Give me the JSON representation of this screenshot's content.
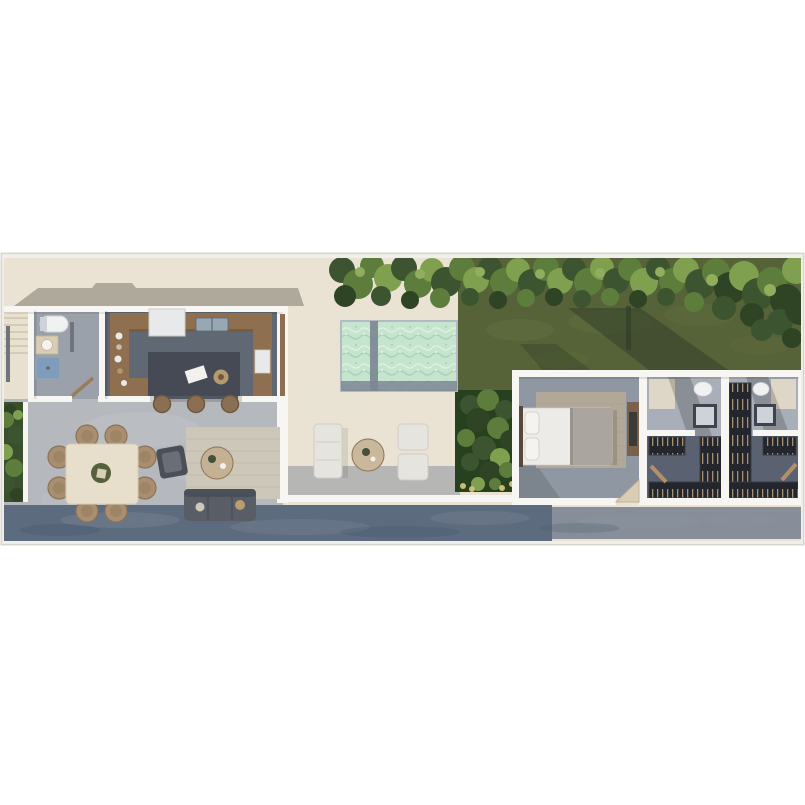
{
  "meta": {
    "kind": "aerial-3d-floor-plan-render",
    "canvas": {
      "width": 805,
      "height": 805
    },
    "plan_strip": {
      "top": 252,
      "height": 294
    }
  },
  "scene": {
    "description": "Top-down 3D rendering of a narrow-lot single-story home",
    "zones_left_to_right": [
      "staircase",
      "bathroom",
      "kitchen",
      "open living-dining",
      "pool terrace",
      "lawn with hedge",
      "garden bed",
      "bedroom",
      "closet-bath suite 1",
      "closet-bath suite 2",
      "street walkway"
    ],
    "furniture_counts": {
      "dining_chairs": 8,
      "bar_stools": 3,
      "outdoor_armchairs": 2,
      "outdoor_sofas": 1,
      "indoor_sofas": 1,
      "beds": 1
    },
    "pool_sections": 2
  },
  "palette": {
    "frame": "#f1efec",
    "frameEdge": "#d8d5cf",
    "cream": "#eae2d2",
    "roofShadow": "#a9a396",
    "wall": "#f8f6f2",
    "stairs": "#e9e1d0",
    "stairLine": "#cfc5ae",
    "rail": "#70747c",
    "floorLiving": "#b5b8bc",
    "floorPatch": "#c4c7ca",
    "floorKitchen": "#606874",
    "floorBath": "#9aa1ab",
    "wood": "#8e6f4f",
    "woodDark": "#6d5238",
    "appliance": "#e8e9ea",
    "sinkBlue": "#97a7b4",
    "showerBlue": "#7f9cba",
    "island": "#454a54",
    "paper": "#f2f1ee",
    "bowlTan": "#b5996f",
    "stool": "#8a6f52",
    "stoolEdge": "#6f583f",
    "tableCream": "#e7dfcb",
    "tableEdge": "#d6cbb2",
    "chairTan": "#a98f6f",
    "chairEdge": "#8a7357",
    "centerDark": "#55603d",
    "centerBeige": "#d9cfb8",
    "rugLiving": "#cdc7ba",
    "rugLine": "#b9b2a2",
    "armchair": "#4b5058",
    "armchairSeat": "#6a6f77",
    "coffeeTable": "#c4b193",
    "sofa": "#585d66",
    "sofaBack": "#4a4f58",
    "throwTan": "#b99e72",
    "throwLight": "#cfc9bb",
    "planterBase": "#3a4f2c",
    "gardenBase": "#27401f",
    "g1": "#3c5530",
    "g2": "#5d7d3c",
    "g3": "#7fa04e",
    "g4": "#2e4424",
    "g5": "#93ad5e",
    "flower": "#c9bd72",
    "grass": "#566238",
    "grassLight": "#61703f",
    "treeShadow": "#2f3b28",
    "deckShadow": "#8b929c",
    "poolWater": "#c6e5cf",
    "poolLight": "#def0e2",
    "poolDeep": "#a9d2b8",
    "poolEdgeDark": "#7b8694",
    "poolStroke": "#b3bac2",
    "outdoorWhite": "#e6e4de",
    "outdoorEdge": "#cfccc4",
    "outdoorTable": "#c9b89b",
    "outdoorDeco": "#44503a",
    "streetDark": "#5c6b7e",
    "streetLight": "#878e99",
    "streetPatchLight": "#8b97a6",
    "streetPatchDark": "#46566b",
    "floorBedroom": "#8e97a2",
    "rugBedroom": "#b2a898",
    "rugBedLine": "#a69c8c",
    "bedWhite": "#ecebe7",
    "bedGray": "#aaa69f",
    "bedFold": "#98948d",
    "pillow": "#f4f3f0",
    "headboard": "#54493c",
    "dresser": "#7b614a",
    "dresserDark": "#3c3a36",
    "doorWood": "#9a7b5a",
    "doorSwing": "#d9cdb6",
    "doorSwingEdge": "#c2b396",
    "terraceDoorWood": "#8d6e50",
    "suiteFloorTop": "#a9afb8",
    "suiteWallCream": "#e3dbc9",
    "closetFloor": "#5a6170",
    "shelf": "#23262c",
    "shelfEdge": "#3a3d44",
    "clothes": "#a8906a",
    "vanityDark": "#3f444c",
    "vanityTop": "#cdd3d8",
    "fixtureWhite": "#f0f1f1",
    "fixtureEdge": "#d2d4d6",
    "ladder": "#b3906a",
    "dishWhite": "#eceae6",
    "dishBeige": "#cbbfa9"
  },
  "vegetation": {
    "hedge": [
      [
        342,
        270,
        13,
        "g1"
      ],
      [
        358,
        284,
        15,
        "g2"
      ],
      [
        345,
        296,
        11,
        "g4"
      ],
      [
        372,
        266,
        12,
        "g2"
      ],
      [
        388,
        278,
        14,
        "g3"
      ],
      [
        381,
        296,
        10,
        "g1"
      ],
      [
        404,
        268,
        13,
        "g1"
      ],
      [
        418,
        284,
        14,
        "g2"
      ],
      [
        410,
        300,
        9,
        "g4"
      ],
      [
        432,
        270,
        12,
        "g3"
      ],
      [
        446,
        282,
        15,
        "g1"
      ],
      [
        440,
        298,
        10,
        "g2"
      ],
      [
        462,
        268,
        13,
        "g2"
      ],
      [
        476,
        280,
        13,
        "g3"
      ],
      [
        470,
        297,
        9,
        "g1"
      ],
      [
        490,
        268,
        12,
        "g1"
      ],
      [
        504,
        282,
        14,
        "g2"
      ],
      [
        498,
        300,
        9,
        "g4"
      ],
      [
        518,
        270,
        12,
        "g3"
      ],
      [
        532,
        283,
        14,
        "g1"
      ],
      [
        526,
        298,
        9,
        "g2"
      ],
      [
        546,
        268,
        13,
        "g2"
      ],
      [
        560,
        281,
        13,
        "g3"
      ],
      [
        554,
        297,
        9,
        "g4"
      ],
      [
        574,
        269,
        12,
        "g1"
      ],
      [
        588,
        282,
        14,
        "g2"
      ],
      [
        582,
        299,
        9,
        "g1"
      ],
      [
        602,
        268,
        12,
        "g3"
      ],
      [
        616,
        281,
        13,
        "g1"
      ],
      [
        610,
        297,
        9,
        "g2"
      ],
      [
        630,
        269,
        12,
        "g2"
      ],
      [
        644,
        282,
        14,
        "g3"
      ],
      [
        638,
        299,
        9,
        "g4"
      ],
      [
        658,
        268,
        12,
        "g1"
      ],
      [
        672,
        281,
        13,
        "g2"
      ],
      [
        666,
        297,
        9,
        "g1"
      ],
      [
        686,
        270,
        13,
        "g3"
      ],
      [
        700,
        284,
        15,
        "g1"
      ],
      [
        694,
        302,
        10,
        "g2"
      ],
      [
        716,
        272,
        14,
        "g2"
      ],
      [
        730,
        288,
        16,
        "g4"
      ],
      [
        724,
        308,
        12,
        "g1"
      ],
      [
        744,
        276,
        15,
        "g3"
      ],
      [
        758,
        294,
        16,
        "g1"
      ],
      [
        752,
        315,
        12,
        "g4"
      ],
      [
        772,
        282,
        15,
        "g2"
      ],
      [
        786,
        300,
        16,
        "g4"
      ],
      [
        780,
        322,
        13,
        "g1"
      ],
      [
        796,
        270,
        14,
        "g3"
      ],
      [
        800,
        310,
        15,
        "g4"
      ],
      [
        792,
        338,
        10,
        "g4"
      ],
      [
        762,
        330,
        11,
        "g1"
      ],
      [
        360,
        272,
        5,
        "g5"
      ],
      [
        420,
        274,
        5,
        "g5"
      ],
      [
        480,
        272,
        5,
        "g5"
      ],
      [
        540,
        274,
        5,
        "g5"
      ],
      [
        600,
        273,
        5,
        "g5"
      ],
      [
        660,
        272,
        5,
        "g5"
      ],
      [
        712,
        280,
        6,
        "g5"
      ],
      [
        770,
        290,
        6,
        "g5"
      ]
    ],
    "planter": [
      [
        10,
        410,
        6,
        "g4"
      ],
      [
        18,
        415,
        5,
        "g3"
      ],
      [
        6,
        420,
        8,
        "g2"
      ],
      [
        16,
        435,
        9,
        "g1"
      ],
      [
        5,
        452,
        8,
        "g3"
      ],
      [
        14,
        468,
        9,
        "g2"
      ],
      [
        7,
        484,
        8,
        "g1"
      ],
      [
        17,
        495,
        7,
        "g4"
      ]
    ],
    "garden": [
      [
        470,
        405,
        10,
        "g1"
      ],
      [
        488,
        400,
        11,
        "g2"
      ],
      [
        505,
        410,
        10,
        "g1"
      ],
      [
        478,
        420,
        12,
        "g4"
      ],
      [
        498,
        428,
        11,
        "g2"
      ],
      [
        466,
        438,
        9,
        "g2"
      ],
      [
        510,
        440,
        10,
        "g4"
      ],
      [
        484,
        448,
        12,
        "g1"
      ],
      [
        500,
        458,
        10,
        "g3"
      ],
      [
        470,
        462,
        9,
        "g1"
      ],
      [
        490,
        472,
        11,
        "g4"
      ],
      [
        507,
        470,
        8,
        "g2"
      ],
      [
        478,
        484,
        7,
        "g3"
      ],
      [
        495,
        484,
        6,
        "g2"
      ]
    ],
    "flowers": [
      [
        463,
        486,
        3
      ],
      [
        472,
        489,
        3
      ],
      [
        502,
        488,
        3
      ],
      [
        512,
        484,
        3
      ]
    ]
  },
  "ground": {
    "grass_patches": [
      [
        520,
        330,
        34,
        11,
        "grassLight",
        0.5
      ],
      [
        610,
        322,
        42,
        12,
        "grassLight",
        0.45
      ],
      [
        700,
        315,
        36,
        11,
        "grassLight",
        0.4
      ],
      [
        760,
        345,
        30,
        10,
        "grassLight",
        0.35
      ],
      [
        560,
        360,
        28,
        9,
        "grassLight",
        0.35
      ]
    ],
    "street_patches": [
      [
        120,
        520,
        60,
        8,
        "streetPatchLight",
        0.25
      ],
      [
        300,
        527,
        70,
        8,
        "streetPatchLight",
        0.22
      ],
      [
        480,
        518,
        50,
        7,
        "streetPatchLight",
        0.22
      ],
      [
        640,
        522,
        60,
        7,
        "streetPatchLight",
        0.25
      ],
      [
        740,
        520,
        40,
        6,
        "streetPatchLight",
        0.22
      ],
      [
        60,
        530,
        40,
        6,
        "streetPatchDark",
        0.3
      ],
      [
        400,
        532,
        60,
        6,
        "streetPatchDark",
        0.28
      ],
      [
        580,
        528,
        40,
        5,
        "streetPatchDark",
        0.25
      ]
    ],
    "floor_patches": [
      [
        140,
        430,
        60,
        18,
        "floorPatch",
        0.35
      ],
      [
        220,
        470,
        50,
        16,
        "floorPatch",
        0.3
      ],
      [
        80,
        500,
        40,
        12,
        "floorPatch",
        0.25
      ],
      [
        330,
        400,
        40,
        14,
        "poolLight",
        0.12
      ],
      [
        420,
        470,
        40,
        12,
        "poolLight",
        0.1
      ]
    ]
  },
  "furniture": {
    "dining_chairs": [
      [
        87,
        436
      ],
      [
        116,
        436
      ],
      [
        87,
        511
      ],
      [
        116,
        511
      ],
      [
        59,
        457
      ],
      [
        59,
        488
      ],
      [
        145,
        457
      ],
      [
        145,
        488
      ]
    ],
    "bar_stools": [
      [
        162,
        404
      ],
      [
        196,
        404
      ],
      [
        230,
        404
      ]
    ],
    "kitchen_dishes": [
      [
        119,
        326,
        2.5,
        "stool"
      ],
      [
        119,
        336,
        3.5,
        "dishWhite"
      ],
      [
        119,
        347,
        2.8,
        "dishBeige"
      ],
      [
        118,
        359,
        3.5,
        "dishWhite"
      ],
      [
        120,
        371,
        2.8,
        "bowlTan"
      ],
      [
        124,
        383,
        3,
        "dishWhite"
      ]
    ]
  }
}
